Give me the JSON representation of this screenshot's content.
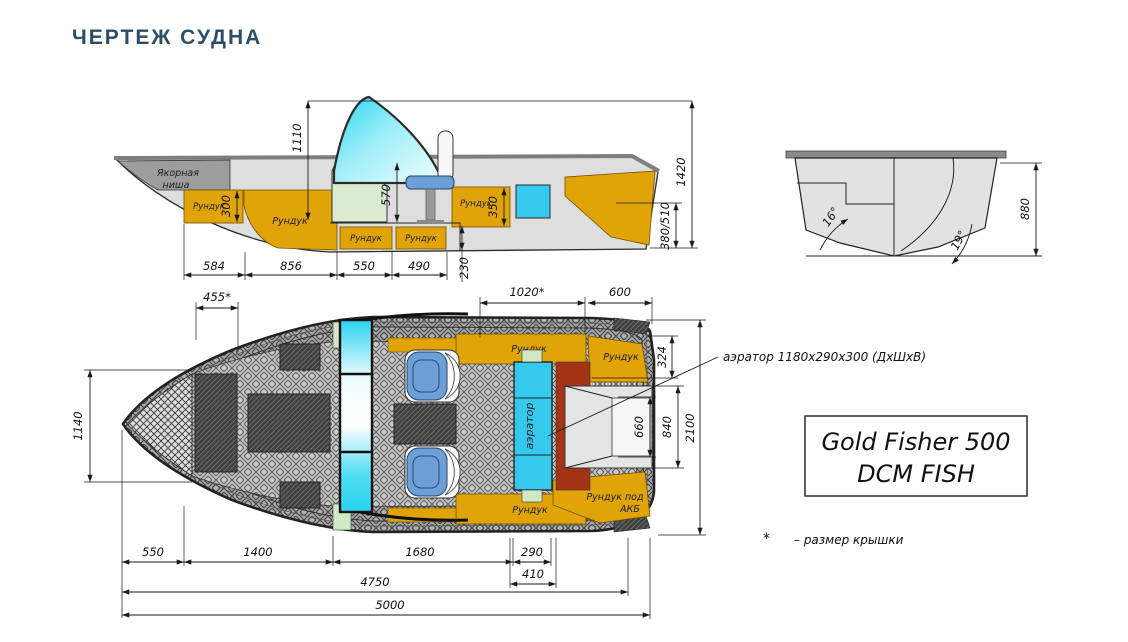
{
  "title": "ЧЕРТЕЖ СУДНА",
  "colors": {
    "title_text": "#2b4d66",
    "locker": "#e0a408",
    "aerator": "#35c9ee",
    "seat": "#6f9fd8",
    "red_box": "#a33415",
    "console": "#d9ecd2",
    "hull_gray": "#dedede"
  },
  "side_view": {
    "anchor_niche_line1": "Якорная",
    "anchor_niche_line2": "ниша",
    "locker": "Рундук",
    "dims": {
      "windshield_top_height": "1110",
      "console_height": "570",
      "bow_locker_depth": "300",
      "stern_locker_depth": "350",
      "overall_height": "1420",
      "transom_height": "380/510",
      "bilge_depth": "230",
      "bottom_seg_1": "584",
      "bottom_seg_2": "856",
      "bottom_seg_3": "550",
      "bottom_seg_4": "490"
    }
  },
  "rear_view": {
    "deadrise_mid": "16°",
    "deadrise_transom": "19°",
    "hull_height": "880"
  },
  "plan_view": {
    "locker": "Рундук",
    "battery_locker_line1": "Рундук под",
    "battery_locker_line2": "АКБ",
    "aerator": "аэратор",
    "dims": {
      "bow_hatch_width": "455*",
      "cockpit_hatch_width": "1020*",
      "stern_deck_width": "600",
      "stern_locker_width": "324",
      "bow_width": "1140",
      "motor_well_inner": "660",
      "motor_well_outer": "840",
      "beam": "2100",
      "bottom_seg_1": "550",
      "bottom_seg_2": "1400",
      "bottom_seg_3": "1680",
      "aerator_width": "290",
      "aerator_bay_width": "410",
      "cockpit_length": "4750",
      "overall_length": "5000"
    }
  },
  "annotations": {
    "aerator_note": "аэратор 1180х290х300 (ДхШхВ)",
    "footnote_marker": "*",
    "footnote_text": "– размер крышки"
  },
  "model_plate": {
    "line1": "Gold Fisher 500",
    "line2": "DCM FISH"
  }
}
